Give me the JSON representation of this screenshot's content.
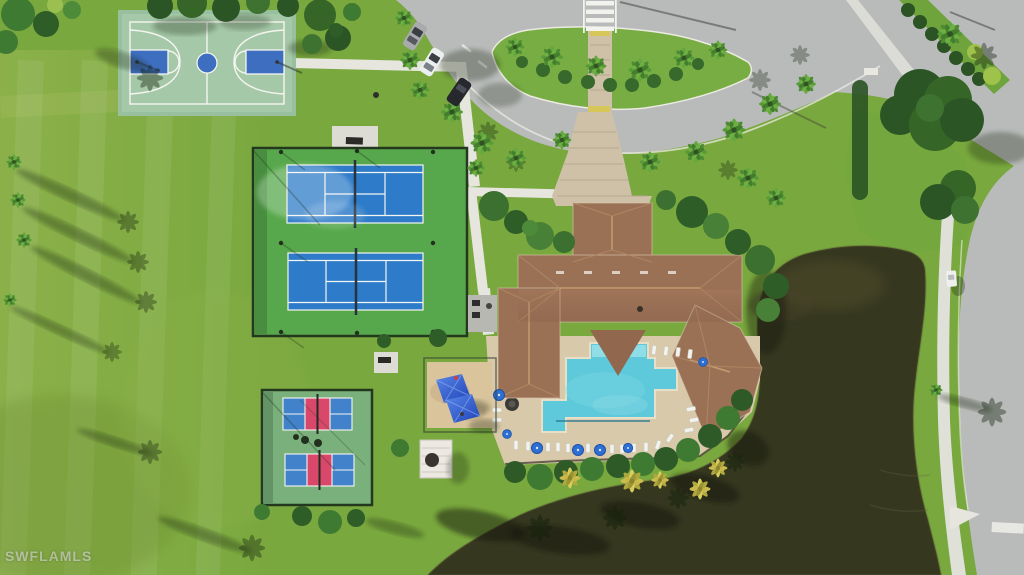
{
  "watermark": {
    "text": "SWFLAMLS"
  },
  "scene": {
    "type": "aerial-photo",
    "description": "Aerial drone view of a community amenity campus: basketball court, two tennis courts, two pickleball courts, clubhouse with resort pool, playground, entry drive with landscaped roundabout, perimeter road and a dark lake"
  },
  "palette": {
    "grass": "#79a83e",
    "grass_light": "#9ab754",
    "asphalt": "#b9bbba",
    "sidewalk": "#dfe0d8",
    "paver": "#cfc0a8",
    "court_sage": "#a5c8a8",
    "court_blue": "#3e6ec0",
    "tennis_green": "#57a84c",
    "tennis_blue": "#2e7cc9",
    "pickle_green": "#79b07c",
    "pickle_blue": "#4182cb",
    "pickle_red": "#d9486b",
    "roof": "#9b7156",
    "deck": "#d9c9ab",
    "sand": "#d9c49c",
    "pool": "#5ec9da",
    "pool_shelf": "#8fdde6",
    "lake": "#35371f",
    "umbrella": "#2e6fd4"
  }
}
